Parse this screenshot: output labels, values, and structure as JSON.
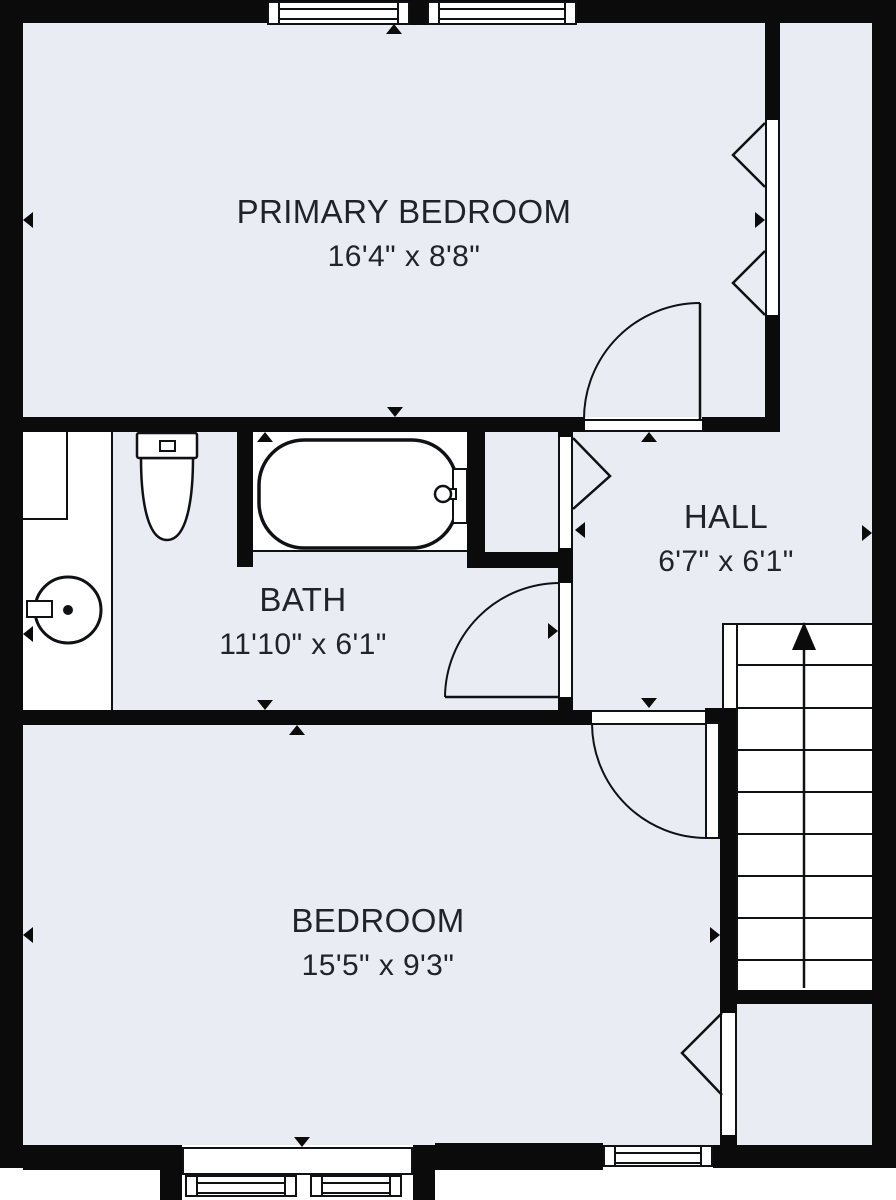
{
  "plan": {
    "type": "residential-floor-plan",
    "colors": {
      "floor": "#e9edf3",
      "wall": "#0b0b0c",
      "line": "#101114",
      "text": "#1f232a",
      "background": "#ffffff"
    },
    "rooms": [
      {
        "name": "PRIMARY BEDROOM",
        "dimensions": "16'4\" x 8'8\""
      },
      {
        "name": "BATH",
        "dimensions": "11'10\" x 6'1\""
      },
      {
        "name": "HALL",
        "dimensions": "6'7\" x 6'1\""
      },
      {
        "name": "BEDROOM",
        "dimensions": "15'5\" x 9'3\""
      }
    ],
    "fixtures": [
      "toilet",
      "bathtub",
      "sink",
      "vanity-closet",
      "staircase-up"
    ],
    "features": [
      "windows",
      "bay-window",
      "swing-doors",
      "passage-openings",
      "stair-direction-arrow"
    ]
  }
}
